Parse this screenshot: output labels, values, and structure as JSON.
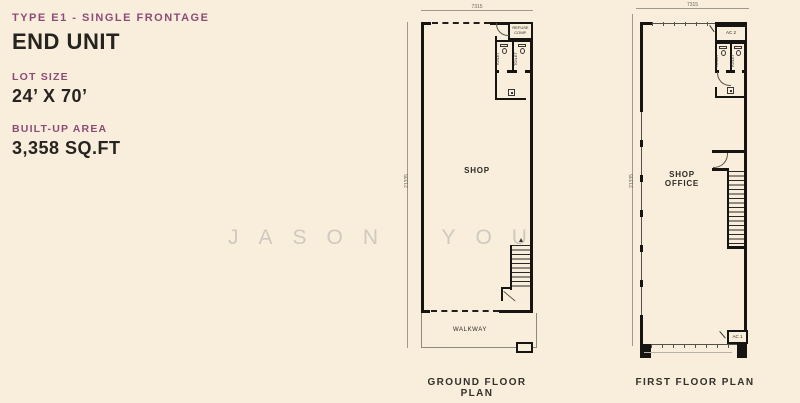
{
  "colors": {
    "background": "#f8eedb",
    "accent": "#8d4c77",
    "ink": "#262320",
    "wall": "#171512",
    "watermark": "#cfc9bf"
  },
  "info": {
    "type_label": "TYPE E1 - SINGLE FRONTAGE",
    "unit_label": "END UNIT",
    "lot_size_label": "LOT SIZE",
    "lot_size_value": "24’ X 70’",
    "built_up_label": "BUILT-UP AREA",
    "built_up_value": "3,358 SQ.FT"
  },
  "watermark": {
    "text": "JASON YOU"
  },
  "ground_floor": {
    "caption": "GROUND FLOOR PLAN",
    "dim_width": "7315",
    "dim_height": "21335",
    "labels": {
      "shop": "SHOP",
      "walkway": "WALKWAY",
      "refuse": "REFUSE COMP.",
      "toilet_left": "TOILET",
      "toilet_right": "TOILET"
    }
  },
  "first_floor": {
    "caption": "FIRST FLOOR PLAN",
    "dim_width": "7315",
    "dim_height": "21335",
    "labels": {
      "shop_office_line1": "SHOP",
      "shop_office_line2": "OFFICE",
      "ac1": "AC 1",
      "ac2": "AC 2",
      "toilet_left": "TOILET",
      "toilet_right": "TOILET"
    }
  }
}
